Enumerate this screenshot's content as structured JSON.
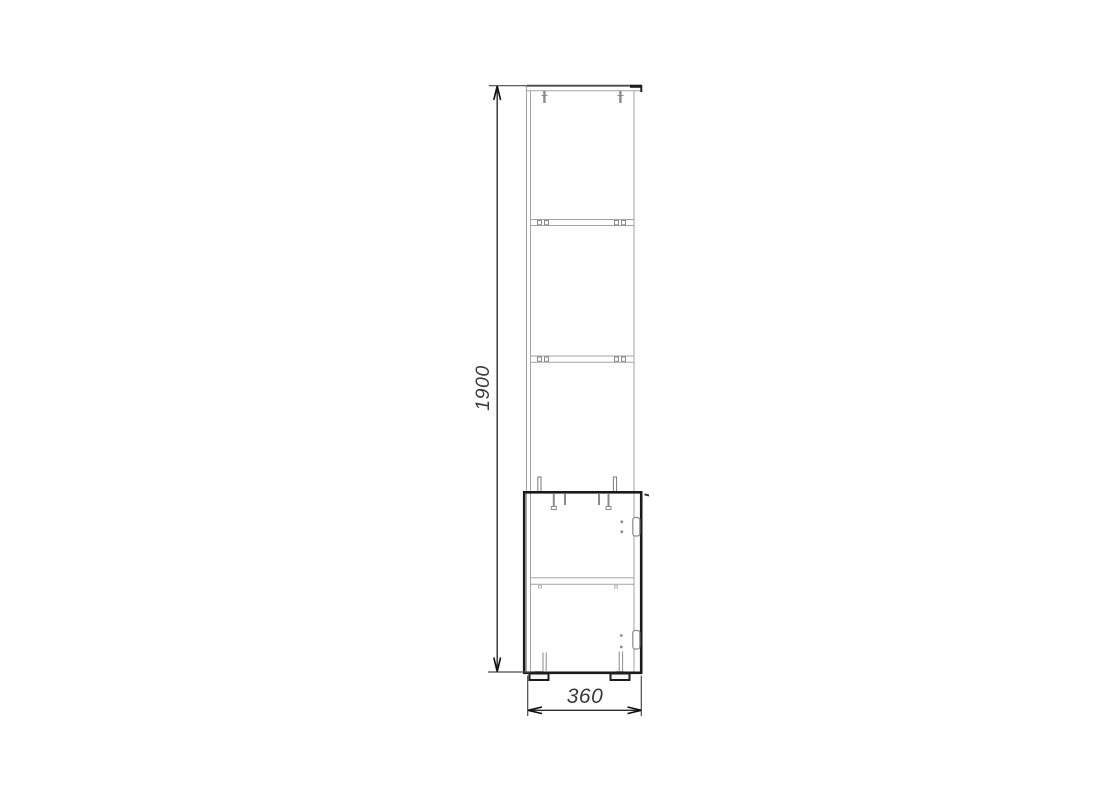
{
  "drawing": {
    "type": "furniture-technical-drawing",
    "subject": "tall cabinet with open shelves and lower door, front elevation",
    "dimensions": {
      "height": {
        "label": "1900"
      },
      "width": {
        "label": "360"
      }
    },
    "colors": {
      "background": "#ffffff",
      "thin_line": "#a3a3a3",
      "medium_line": "#8a8a8a",
      "bold_line": "#1a1a1a",
      "dim_line": "#2e2e2e"
    }
  }
}
